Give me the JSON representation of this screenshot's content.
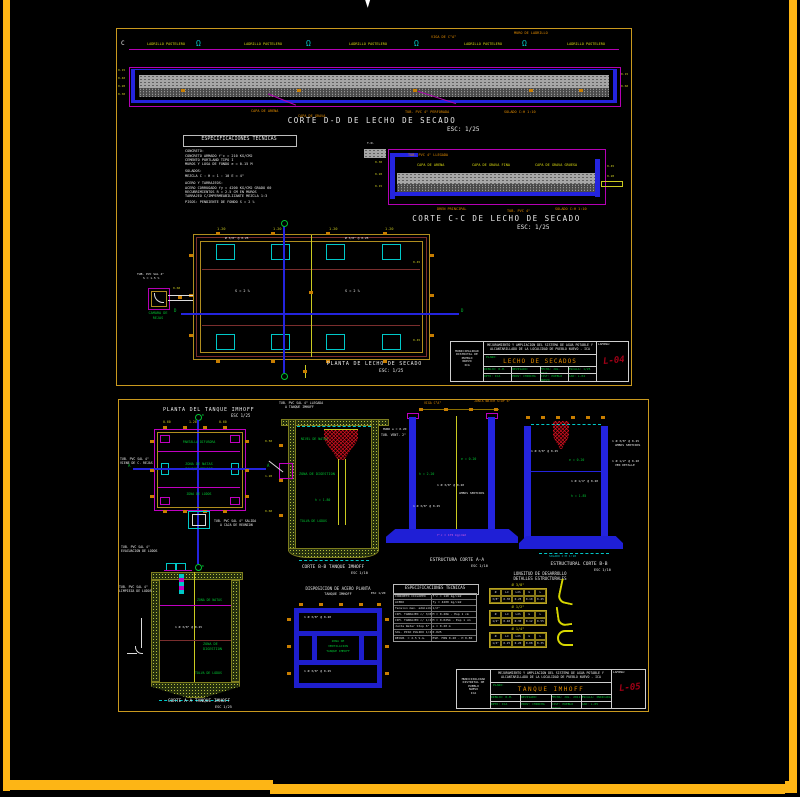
{
  "colors": {
    "background": "#000000",
    "frame_orange": "#fdb515",
    "sheet_border_gold": "#c9991e",
    "cad_magenta": "#b400b4",
    "cad_blue": "#1f1fd6",
    "cad_cyan": "#00c8c8",
    "cad_yellow": "#d9d910",
    "cad_green": "#00c432",
    "cad_orange": "#c87d00",
    "stamp_red": "#a00016"
  },
  "sheet1": {
    "section_marker": "C",
    "corte_dd": {
      "title": "CORTE D-D DE LECHO DE SECADO",
      "scale": "ESC: 1/25",
      "vent_symbol": "Ω",
      "top_labels": [
        "LADRILLO PASTELERO",
        "LADRILLO PASTELERO",
        "LADRILLO PASTELERO",
        "LADRILLO PASTELERO",
        "LADRILLO PASTELERO"
      ],
      "leader_labels": [
        "VIGA DE C°A°",
        "MURO DE LADRILLO"
      ],
      "tag_labels": [
        "CAPA DE ARENA",
        "CAPA DE GRAVA",
        "TUB. PVC 4\" PERFORADA",
        "SOLADO C:H 1:10"
      ],
      "left_dims": [
        "0.15",
        "0.40",
        "0.20",
        "0.30"
      ],
      "right_dims": [
        "0.15",
        "0.60"
      ]
    },
    "specs": {
      "title": "ESPECIFICACIONES  TECNICAS",
      "lines": [
        "CONCRETO:",
        "  CONCRETO ARMADO f'c = 210 KG/CM2",
        "  CEMENTO PORTLAND TIPO I",
        "  MUROS Y LOSA DE FONDO  e = 0.15 M",
        "SOLADOS:",
        "  MEZCLA  C : H = 1 : 10   E = 4\"",
        "ACERO Y TARRAJEOS:",
        "  ACERO CORRUGADO fy = 4200 KG/CM2 GRADO 60",
        "  RECUBRIMIENTOS  R = 2.5 CM EN MUROS",
        "  TARRAJEO C/IMPERMEABILIZANTE MEZCLA 1:3",
        "  PISOS: PENDIENTE DE FONDO  S = 2 %"
      ]
    },
    "corte_cc": {
      "title": "CORTE C-C DE LECHO DE SECADO",
      "scale": "ESC: 1/25",
      "top_labels": [
        "CAPA DE ARENA",
        "CAPA DE GRAVA FINA",
        "CAPA DE GRAVA GRUESA"
      ],
      "inlet_label": "TUB. PVC 4\" LLEGADA",
      "terrain_label": "T.N.",
      "tag_labels": [
        "DREN PRINCIPAL",
        "TUB. PVC 4\"",
        "SOLADO C:H 1:10"
      ],
      "left_dims": [
        "0.30",
        "0.20",
        "0.15"
      ],
      "right_dims": [
        "0.45",
        "0.20"
      ]
    },
    "planta": {
      "title": "PLANTA DE LECHO DE SECADO",
      "scale": "ESC: 1/25",
      "axis_label_left": "D",
      "axis_label_right": "D",
      "slope_label_1": "S = 2 %",
      "slope_label_2": "S = 2 %",
      "rebar_label_1": "Ø 3/8\" @ 0.25",
      "rebar_label_2": "Ø 3/8\" @ 0.25",
      "camara_lines": [
        "CAMARA DE",
        "REJAS"
      ],
      "camara_pipe_label": "TUB. PVC SAL 4\"",
      "camara_pipe_label2": "S = 1.5 %",
      "connector_dim": "0.60",
      "top_dims": [
        "1.20",
        "1.20",
        "1.20",
        "1.20"
      ],
      "side_dims": [
        "0.45",
        "0.45"
      ]
    },
    "titleblock": {
      "entity": [
        "MUNICIPALIDAD",
        "DISTRITAL DE",
        "PUEBLO",
        "NUEVO",
        "ICA"
      ],
      "project_line1": "MEJORAMIENTO Y AMPLIACION DEL SISTEMA DE AGUA POTABLE Y",
      "project_line2": "ALCANTARILLADO DE LA LOCALIDAD DE PUEBLO NUEVO - ICA",
      "plano_label": "PLANO:",
      "sheet_title": "LECHO DE SECADOS",
      "fields_row1": [
        "DIBUJO: R.M.",
        "REVISADO:",
        "FECHA: JUL. 2011",
        "ESCALA: 1/25"
      ],
      "fields_row2": [
        "DPTO: ICA",
        "PROV: CHINCHA",
        "DIST: PUEBLO NUEVO",
        "CAD: L-04"
      ],
      "stamp_label": "LAMINA:",
      "stamp": "L-04"
    }
  },
  "sheet2": {
    "heading": {
      "title": "PLANTA DEL TANQUE IMHOFF",
      "scale": "ESC 1/25"
    },
    "inlet_label_lines": [
      "TUB. PVC SAL 4\" LLEGADA",
      "A TANQUE IMHOFF"
    ],
    "plan": {
      "center_lines": [
        "ZONA DE NATAS",
        "TANQUE IMHOFF"
      ],
      "upper_label": "PANTALLA DIFUSORA",
      "lower_label": "ZONA DE LODOS",
      "axis_left": "A",
      "axis_right": "A",
      "axis_top": "B",
      "axis_bottom": "B",
      "left_label_lines": [
        "TUB. PVC SAL 4\"",
        "VIENE DE C. REJAS"
      ],
      "top_dims": [
        "0.60",
        "1.20",
        "0.60"
      ]
    },
    "outlet_label_lines": [
      "TUB. PVC SAL 4\" SALIDA",
      "A CAJA DE REUNION"
    ],
    "drain_label_lines": [
      "TUB. PVC SAL 4\"",
      "EVACUACION DE LODOS"
    ],
    "corte_bb": {
      "title": "CORTE B-B TANQUE IMHOFF",
      "scale": "ESC 1/10",
      "green_labels": [
        "NIVEL DE NATAS",
        "ZONA DE DIGESTION",
        "h = 1.80",
        "TOLVA DE LODOS"
      ],
      "white_label": "TUB. VENT. 2\"",
      "dims": [
        "0.50",
        "1.20",
        "0.60"
      ]
    },
    "corte_aa_est": {
      "title": "ESTRUCTURA CORTE A-A",
      "scale": "ESC 1/10",
      "top_tags": [
        "VIGA C°A°",
        "JUNTA WATER STOP 6\""
      ],
      "green_labels": [
        "e = 0.20",
        "h = 2.20"
      ],
      "white_labels": [
        "1 Ø 3/8\" @ 0.20",
        "AMBOS SENTIDOS",
        "1 Ø 3/8\" @ 0.25"
      ],
      "slab_label": "f'c = 175 kg/cm2",
      "muro_label": "MURO e = 0.20"
    },
    "corte_bb_est": {
      "title": "ESTRUCTURAL CORTE B-B",
      "scale": "ESC 1/10",
      "green_labels": [
        "e = 0.20",
        "h = 1.85"
      ],
      "white_labels": [
        "1 Ø 1/4\" @ 0.20",
        "1 Ø 3/8\" @ 0.25"
      ],
      "right_labels": [
        "1 Ø 3/8\" @ 0.25",
        "AMBOS SENTIDOS",
        "1 Ø 1/2\" @ 0.20",
        "VER DETALLE"
      ],
      "solado_label": "SOLADO C:H 1:10"
    },
    "corte_aa": {
      "title": "CORTE A-A TANQUE IMHOFF",
      "scale": "ESC 1/25",
      "green_labels": [
        "ZONA DE NATAS",
        "ZONA DE",
        "DIGESTION",
        "TOLVA DE LODOS"
      ],
      "white_rebar": "1 Ø 3/8\" @ 0.25",
      "pipe_label_lines": [
        "TUB. PVC SAL 4\"",
        "LIMPIEZA DE LODOS"
      ]
    },
    "acero": {
      "title": "DISPOSICION DE ACERO PLANTA",
      "subtitle": "TANQUE IMHOFF",
      "scale": "ESC 1/20",
      "center_lines": [
        "ZONA DE",
        "VENTILACION",
        "TANQUE IMHOFF"
      ],
      "top_rebar": "1 Ø 3/8\" @ 0.20",
      "bottom_rebar": "1 Ø 3/8\" @ 0.25"
    },
    "specs": {
      "title": "ESPECIFICACIONES  TECNICAS",
      "rows": [
        [
          "CONCRETO CICLOPEO",
          "f'c = 140 kg/cm2"
        ],
        [
          "ACERO",
          "fy = 4200 kg/cm2"
        ],
        [
          "Tension max. admisible",
          "1/2\""
        ],
        [
          "CIM. TARRAJEO c/ 3/8\"",
          "M = 0.20m - Esp 1 cm"
        ],
        [
          "CIM. TARRAJEO c/ 1/2\"",
          "M = 0.025m - Esp 1 cm"
        ],
        [
          "Junta Water Stop 6\"",
          "e = 0.20 m"
        ],
        [
          "SOL. PISO PULIDO 1/2\"",
          "0.025"
        ],
        [
          "RECUB. = 2.5 S.G.",
          "ESP. MIN 0.40 - H 0.80"
        ]
      ]
    },
    "longitud": {
      "title1": "LONGITUD DE DESARROLLO",
      "title2": "DETALLES ESTRUCTURALES",
      "tables": [
        {
          "label": "Ø 3/8\"",
          "headers": [
            "Ø",
            "Ld",
            "Ldh",
            "G",
            "L"
          ],
          "values": [
            "3/8\"",
            "0.30",
            "0.25",
            "0.10",
            "0.45"
          ]
        },
        {
          "label": "Ø 1/2\"",
          "headers": [
            "Ø",
            "Ld",
            "Ldh",
            "G",
            "L"
          ],
          "values": [
            "1/2\"",
            "0.40",
            "0.30",
            "0.12",
            "0.55"
          ]
        },
        {
          "label": "Ø 1/4\"",
          "headers": [
            "Ø",
            "Ld",
            "Ldh",
            "G",
            "L"
          ],
          "values": [
            "1/4\"",
            "0.25",
            "0.20",
            "0.08",
            "0.35"
          ]
        }
      ]
    },
    "titleblock": {
      "entity": [
        "MUNICIPALIDAD",
        "DISTRITAL DE",
        "PUEBLO",
        "NUEVO",
        "ICA"
      ],
      "project_line1": "MEJORAMIENTO Y AMPLIACION DEL SISTEMA DE AGUA POTABLE Y",
      "project_line2": "ALCANTARILLADO DE LA LOCALIDAD DE PUEBLO NUEVO - ICA",
      "plano_label": "PLANO:",
      "sheet_title": "TANQUE IMHOFF",
      "fields_row1": [
        "DIBUJO: R.M.",
        "REVISADO:",
        "FECHA: JUL. 2011",
        "ESCALA: INDICADA"
      ],
      "fields_row2": [
        "DPTO: ICA",
        "PROV: CHINCHA",
        "DIST: PUEBLO NUEVO",
        "CAD: L-05"
      ],
      "stamp_label": "LAMINA:",
      "stamp": "L-05"
    }
  }
}
